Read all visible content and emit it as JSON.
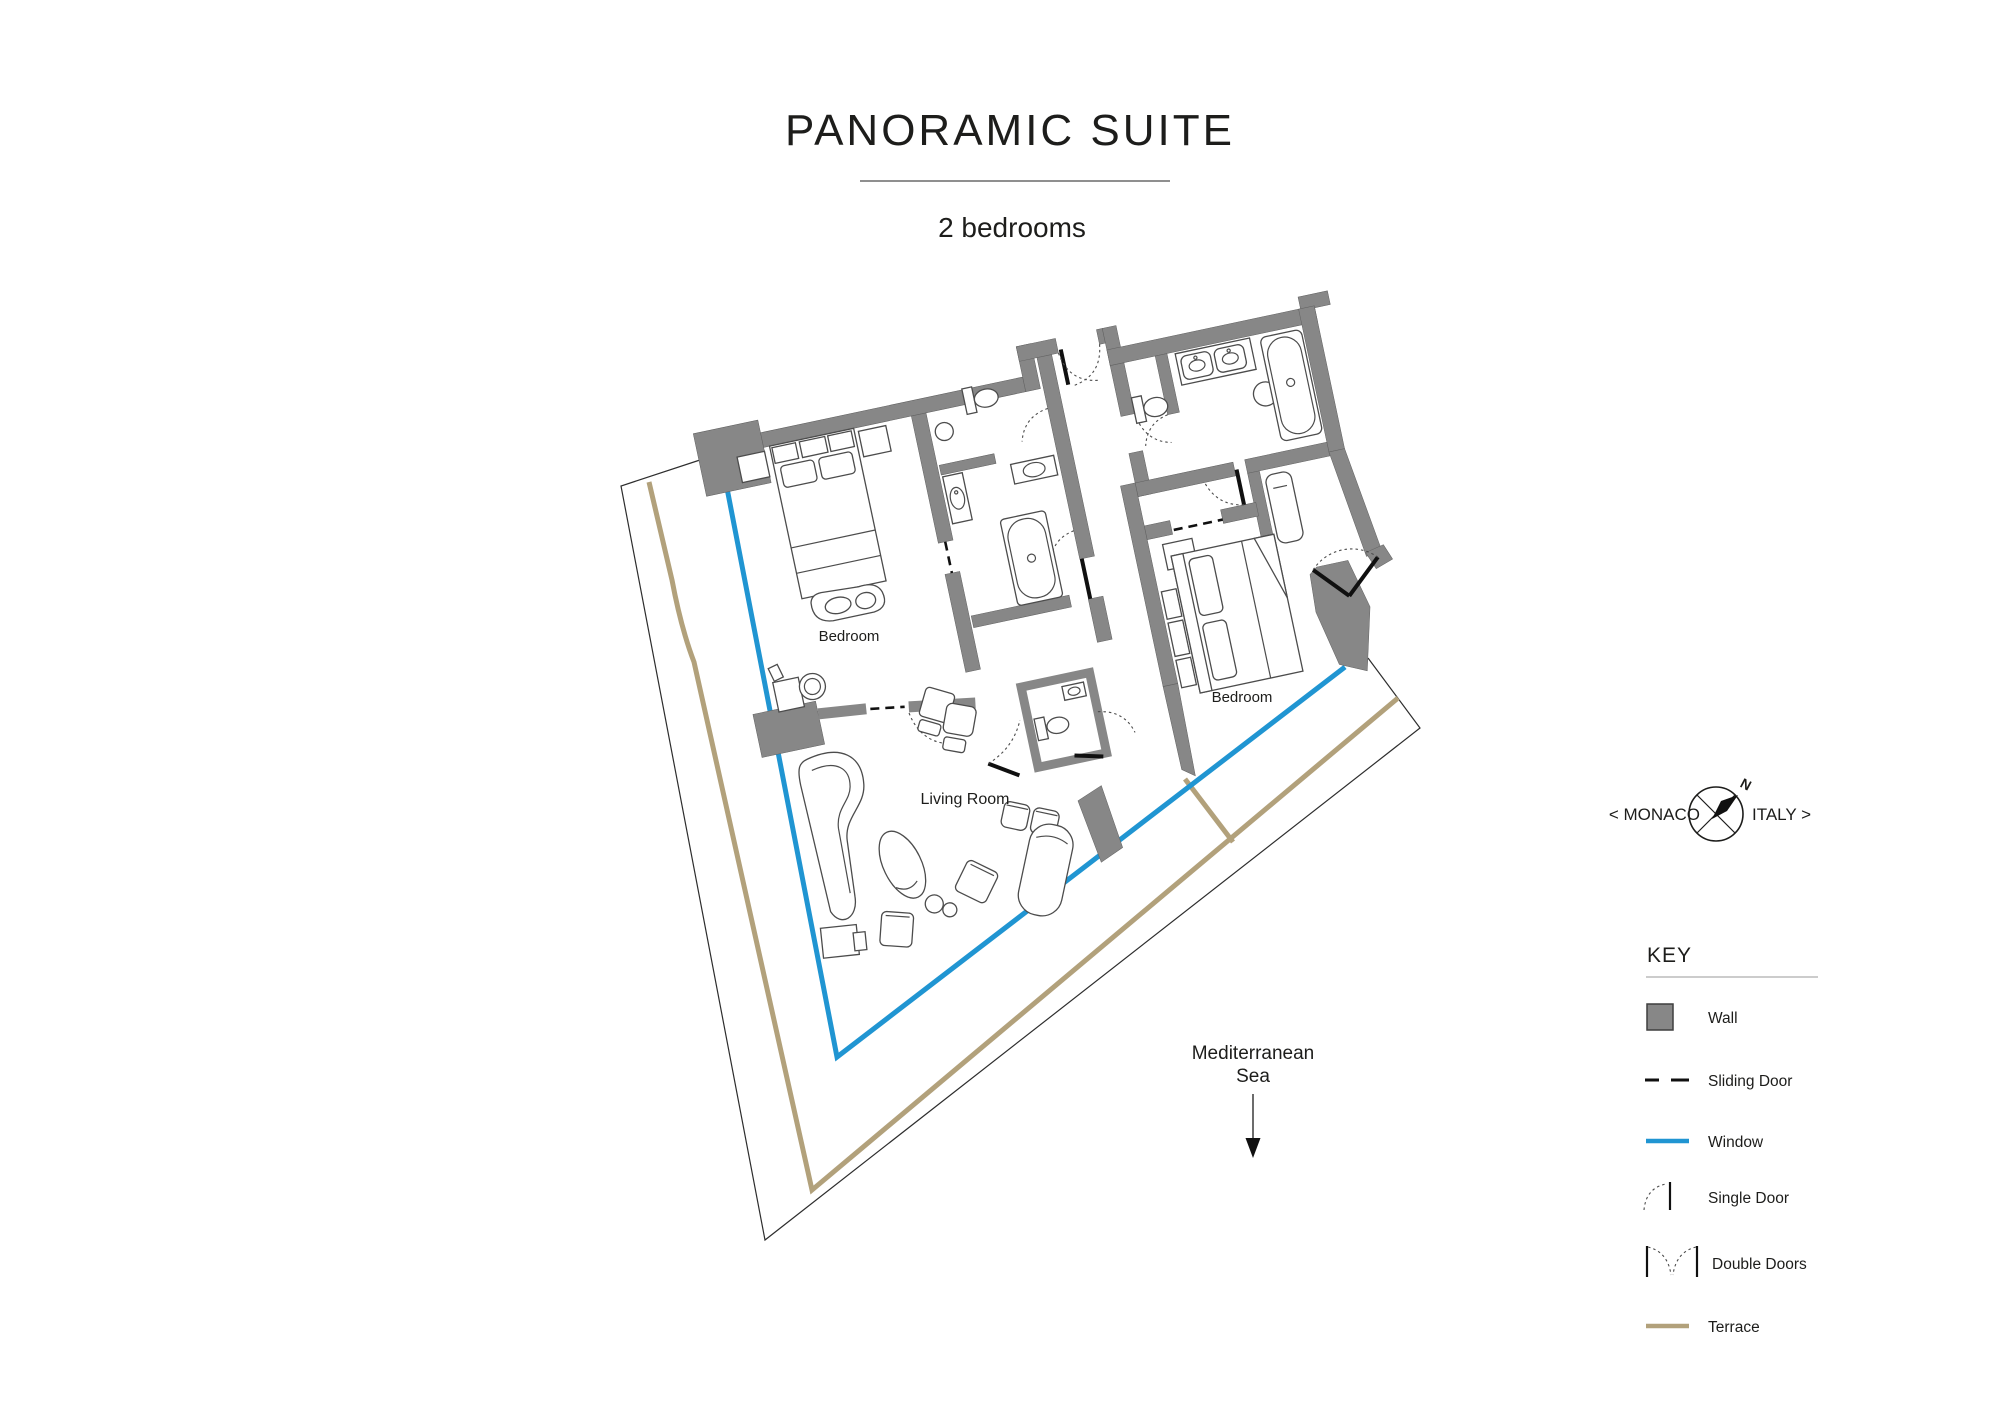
{
  "title": "PANORAMIC SUITE",
  "subtitle": "2 bedrooms",
  "labels": {
    "bedroom1": "Bedroom",
    "bedroom2": "Bedroom",
    "living_room": "Living Room",
    "sea_line1": "Mediterranean",
    "sea_line2": "Sea"
  },
  "compass": {
    "west_label": "< MONACO",
    "east_label": "ITALY >",
    "north_label": "N"
  },
  "key": {
    "title": "KEY",
    "items": [
      {
        "label": "Wall",
        "type": "wall-swatch"
      },
      {
        "label": "Sliding Door",
        "type": "sliding-door-dashes"
      },
      {
        "label": "Window",
        "type": "window-line"
      },
      {
        "label": "Single Door",
        "type": "single-door-arc"
      },
      {
        "label": "Double Doors",
        "type": "double-doors-arcs"
      },
      {
        "label": "Terrace",
        "type": "terrace-line"
      }
    ]
  },
  "colors": {
    "wall": "#878787",
    "window": "#2095d2",
    "terrace": "#b2a17b",
    "ink": "#1d1d1b"
  }
}
